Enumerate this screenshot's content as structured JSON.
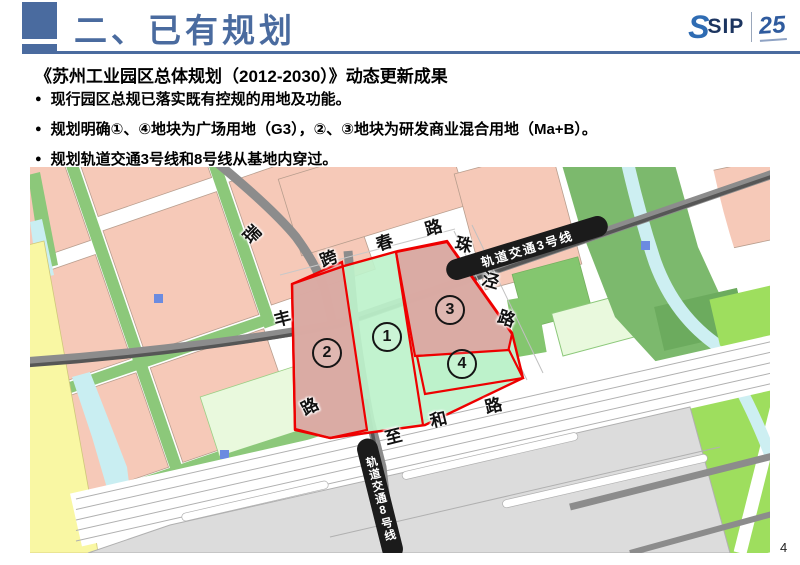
{
  "slide": {
    "header": {
      "title": "二、已有规划",
      "logo_sip": "SIP",
      "logo_anniversary": "25"
    },
    "content": {
      "heading": "《苏州工业园区总体规划（2012-2030）》动态更新成果",
      "bullets": [
        "现行园区总规已落实既有控规的用地及功能。",
        "规划明确①、④地块为广场用地（G3），②、③地块为研发商业混合用地（Ma+B）。",
        "规划轨道交通3号线和8号线从基地内穿过。"
      ]
    },
    "page_number": "4"
  },
  "map": {
    "rail_line_3": "轨道交通3号线",
    "rail_line_8": "轨道交通8号线",
    "plot_markers": {
      "p1": "1",
      "p2": "2",
      "p3": "3",
      "p4": "4"
    },
    "road_labels": {
      "rui": "瑞",
      "kua": "跨",
      "chun": "春",
      "lu_kuachun": "路",
      "zhu": "珠",
      "jing": "泾",
      "lu_zhujing": "路",
      "feng": "丰",
      "lu_feng": "路",
      "zhi": "至",
      "he": "和",
      "lu_zhihe": "路"
    },
    "colors": {
      "plot_mixed_use_pink": "#dba6a1",
      "plot_plaza_green": "#bdf2cb",
      "boundary_red": "#ee0000",
      "rail_label_bg": "#1b1b1b",
      "accent_blue": "#4a6b9f"
    }
  }
}
